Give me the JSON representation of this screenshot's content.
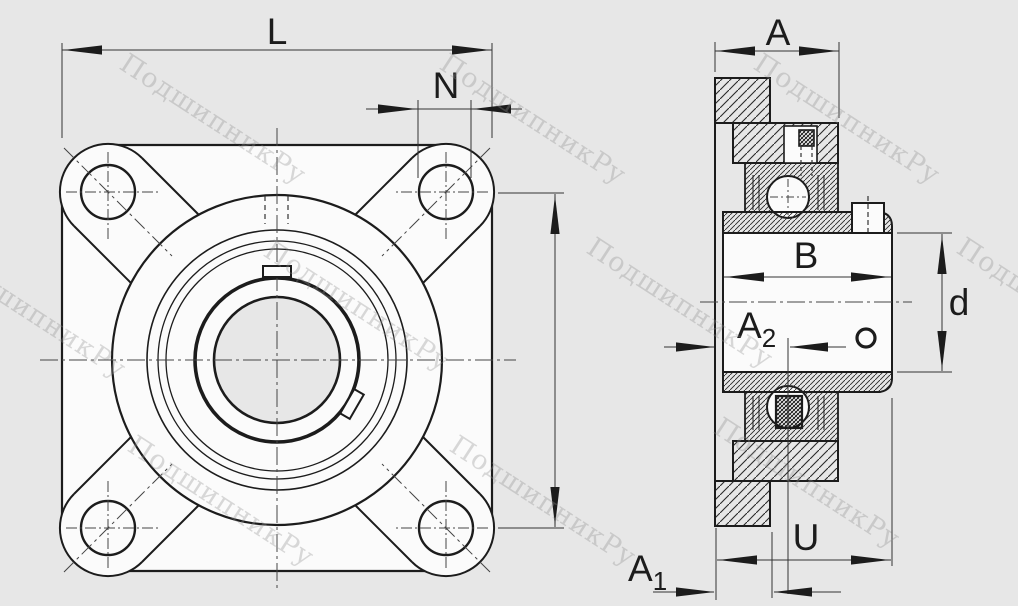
{
  "watermark": {
    "text": "ПодшипникРу",
    "color": "#8f8f8f"
  },
  "drawing": {
    "background_color": "#e7e7e7",
    "line_color": "#1c1c1c",
    "part_fill": "#fbfbfb",
    "front_view": {
      "name": "flange-front-view",
      "dimensions": {
        "L": "L",
        "N": "N"
      }
    },
    "section_view": {
      "name": "bearing-section-view",
      "dimensions": {
        "A": "A",
        "B": "B",
        "d": "d",
        "U": "U",
        "A1": {
          "base": "A",
          "sub": "1"
        },
        "A2": {
          "base": "A",
          "sub": "2"
        }
      }
    }
  }
}
